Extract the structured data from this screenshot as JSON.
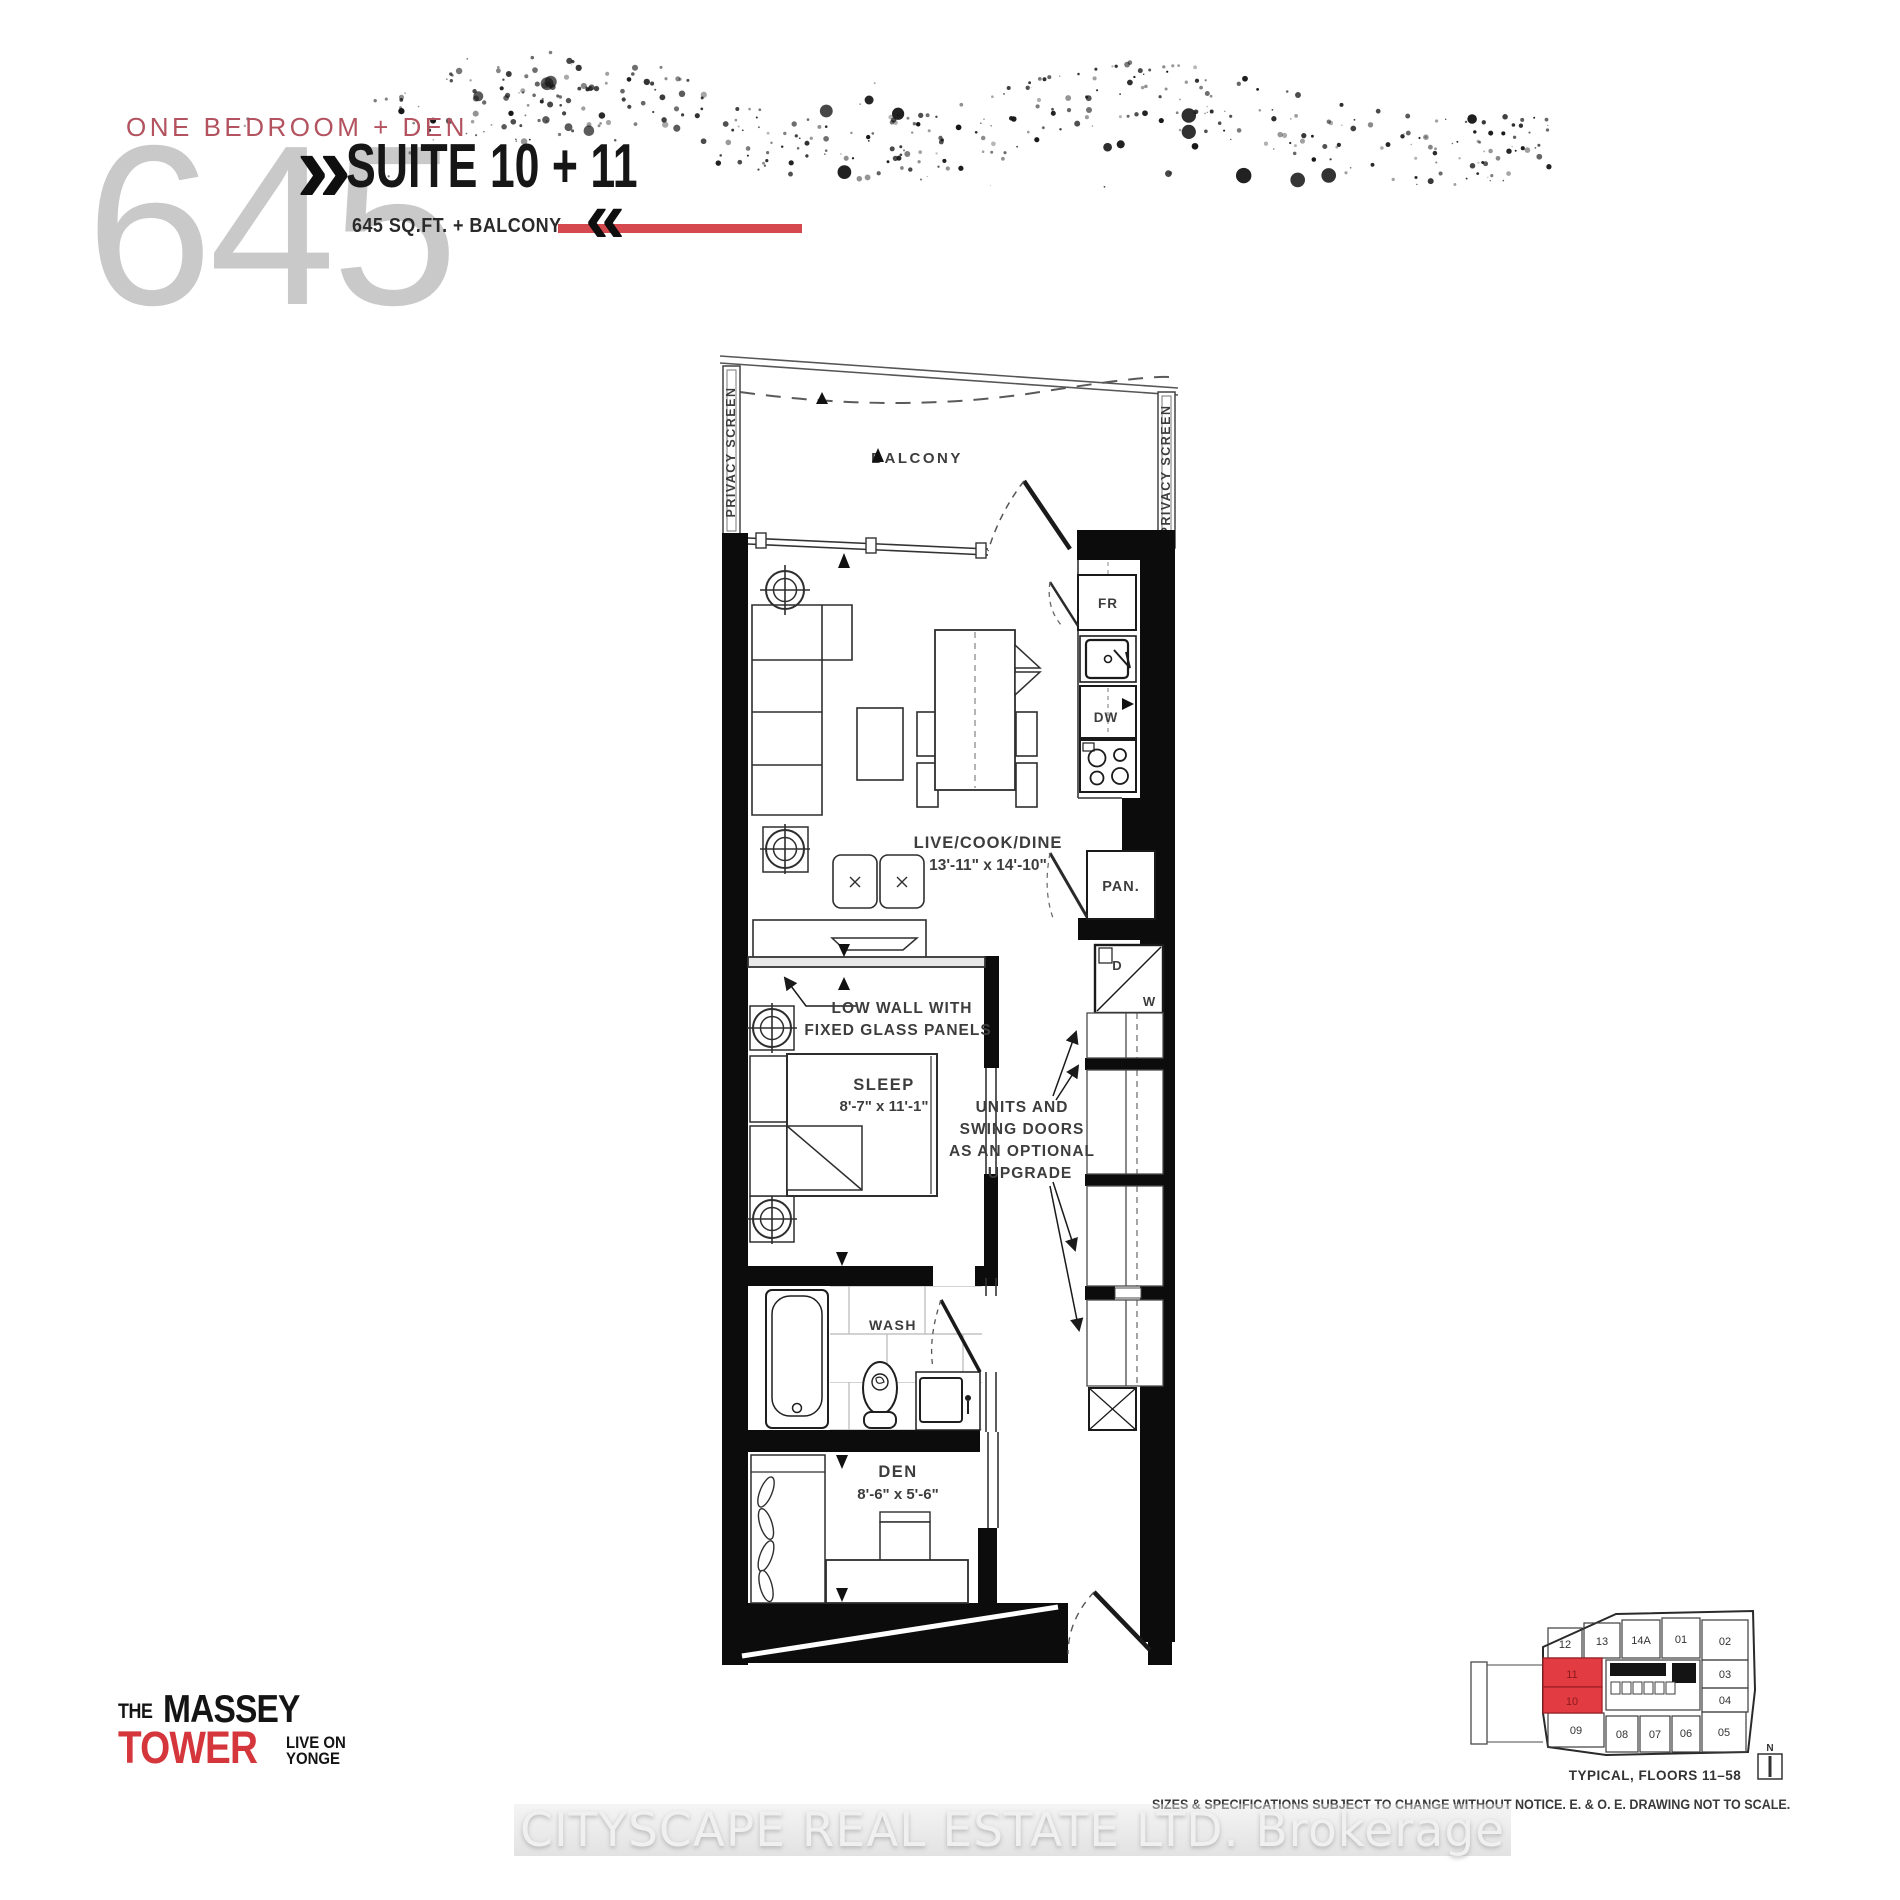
{
  "header": {
    "plan_type": "ONE BEDROOM + DEN",
    "area_number": "645",
    "suite_title": "SUITE 10 + 11",
    "area_detail": "645 SQ.FT. + BALCONY",
    "chevron_right": "»",
    "chevron_left": "«"
  },
  "plan": {
    "balcony": "BALCONY",
    "privacy_screen": "PRIVACY SCREEN",
    "live_line1": "LIVE/COOK/DINE",
    "live_line2": "13'-11\" x 14'-10\"",
    "sleep_line1": "SLEEP",
    "sleep_line2": "8'-7\" x 11'-1\"",
    "den_line1": "DEN",
    "den_line2": "8'-6\" x 5'-6\"",
    "wash": "WASH",
    "pantry": "PAN.",
    "fridge": "FR",
    "dishwasher": "DW",
    "dryer": "D",
    "washer": "W",
    "low_wall_line1": "LOW WALL WITH",
    "low_wall_line2": "FIXED GLASS PANELS",
    "upgrade_line1": "UNITS AND",
    "upgrade_line2": "SWING DOORS",
    "upgrade_line3": "AS AN OPTIONAL",
    "upgrade_line4": "UPGRADE"
  },
  "logo": {
    "the": "THE",
    "massey": "MASSEY",
    "tower": "TOWER",
    "live_on": "LIVE ON",
    "yonge": "YONGE"
  },
  "keyplan": {
    "caption": "TYPICAL, FLOORS 11–58",
    "north": "N",
    "suites": {
      "s12": "12",
      "s13": "13",
      "s14a": "14A",
      "s01": "01",
      "s02": "02",
      "s03": "03",
      "s04": "04",
      "s05": "05",
      "s06": "06",
      "s07": "07",
      "s08": "08",
      "s09": "09",
      "s10": "10",
      "s11": "11"
    },
    "highlighted": [
      "10",
      "11"
    ]
  },
  "footer": {
    "disclaimer": "SIZES & SPECIFICATIONS SUBJECT TO CHANGE WITHOUT NOTICE. E. & O. E. DRAWING NOT TO SCALE.",
    "watermark": "CITYSCAPE REAL ESTATE LTD.  Brokerage"
  },
  "colors": {
    "accent_red": "#d5494e",
    "highlight_red": "#e23b41",
    "highlight_border": "#9c2125",
    "label_red": "#b2535f",
    "number_gray": "#c9c9c9"
  }
}
